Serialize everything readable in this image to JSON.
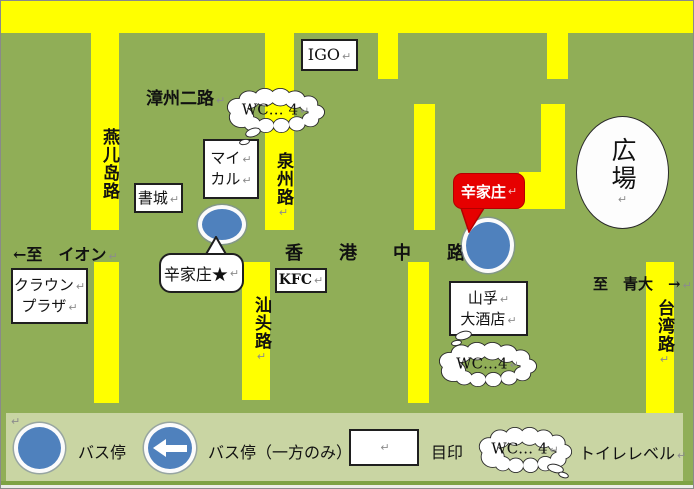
{
  "pilcrow": "↵",
  "colors": {
    "background_green": "#90ae57",
    "road_yellow": "#ffff00",
    "legend_band_green": "#c9d5a3",
    "bus_stop_blue": "#4f81bd",
    "callout_red": "#e60000"
  },
  "streets": {
    "zhangzhou_er": "漳州二路",
    "yanerdao": "燕儿岛路",
    "quanzhou": "泉州路",
    "shantou": "汕头路",
    "taiwan": "台湾路",
    "hongkong_middle": "香港中路",
    "to_aeon": "←至　イオン",
    "to_qingda": "至　青大　→"
  },
  "places": {
    "igo": "IGO",
    "mycal": {
      "line1": "マイ",
      "line2": "カル"
    },
    "bookstore": "書城",
    "kfc": "KFC",
    "crown_plaza": {
      "line1": "クラウン",
      "line2": "プラザ"
    },
    "shanfu_hotel": {
      "line1": "山孚",
      "line2": "大酒店"
    },
    "plaza": "広場",
    "xinjiazhuang_stop": "辛家庄★",
    "xinjiazhuang_callout": "辛家庄",
    "wc_note_north": "WC… 4",
    "wc_note_hotel": "WC…4"
  },
  "legend": {
    "bus_stop_label": "バス停",
    "bus_stop_oneway_label": "バス停（一方のみ）",
    "landmark_label": "目印",
    "wc_note": "WC… 4",
    "toilet_level_label": "トイレレベル"
  }
}
